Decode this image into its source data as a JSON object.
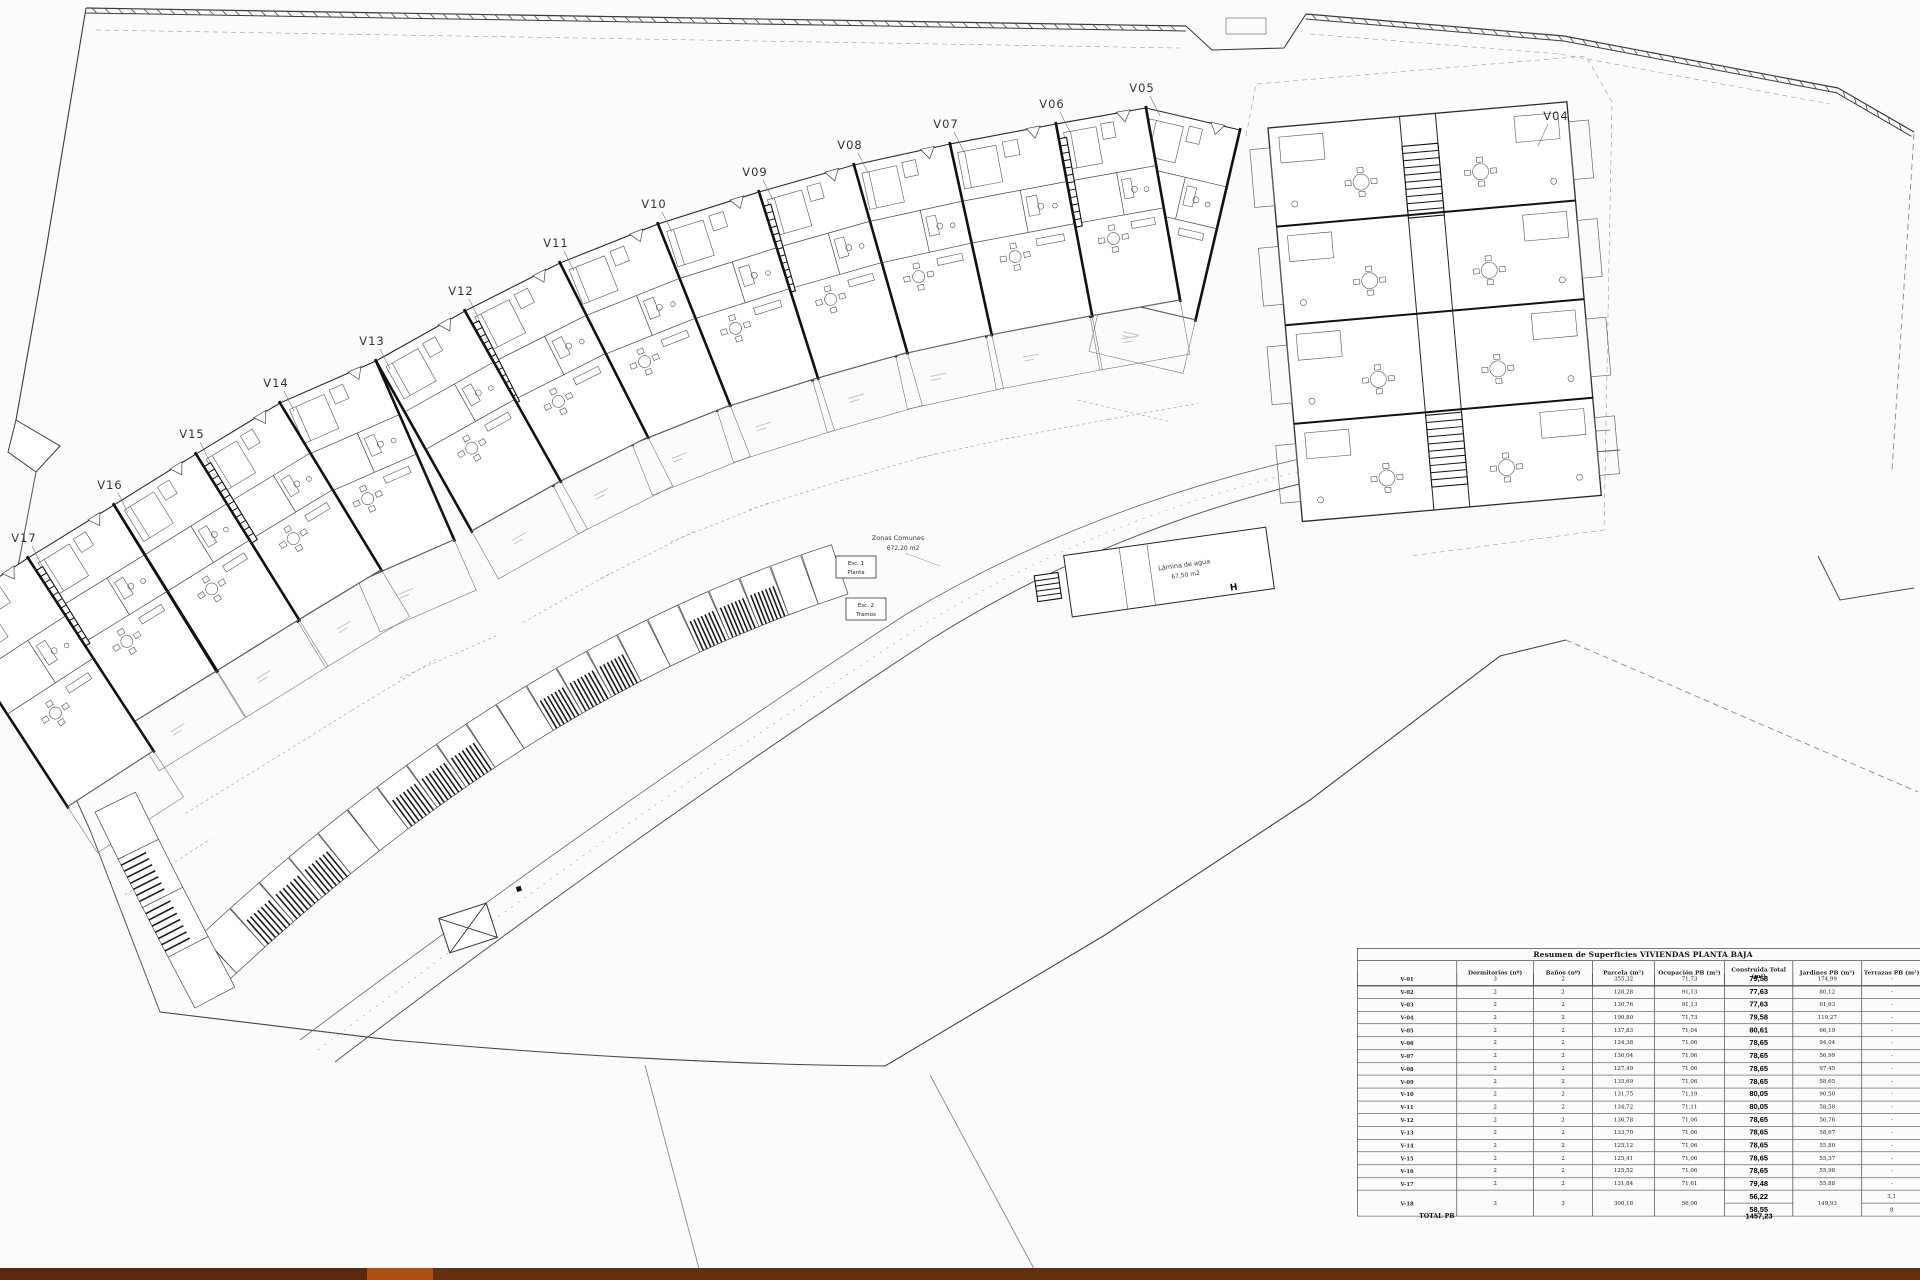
{
  "plan": {
    "paper_color": "#fcfbf9",
    "ink_color": "#2a2a2a",
    "villa_labels": [
      "V05",
      "V06",
      "V07",
      "V08",
      "V09",
      "V10",
      "V11",
      "V12",
      "V13",
      "V14",
      "V15",
      "V16",
      "V17",
      "V04"
    ],
    "annotations": {
      "zonas_comunes": [
        "Zonas Comunes",
        "672,20 m2"
      ],
      "lamina_de_agua": [
        "Lámina de agua",
        "67,50 m2"
      ],
      "esc1": [
        "Esc. 1",
        "Planta"
      ],
      "esc2": [
        "Esc. 2",
        "Tramos"
      ],
      "hydrant": "H"
    }
  },
  "table": {
    "title": "Resumen de Superficies VIVIENDAS PLANTA BAJA",
    "columns": [
      "",
      "Dormitorios (nº)",
      "Baños (nº)",
      "Parcela (m²)",
      "Ocupación PB (m²)",
      "Construida Total (m²)",
      "Jardines PB (m²)",
      "Terrazas PB (m²)"
    ],
    "rows": [
      {
        "id": "V-01",
        "dorm": "3",
        "banos": "2",
        "parcela": "355,32",
        "ocupacion": "71,73",
        "construida": "79,58",
        "jardines": "174,99",
        "terrazas": "-"
      },
      {
        "id": "V-02",
        "dorm": "2",
        "banos": "2",
        "parcela": "128,28",
        "ocupacion": "91,13",
        "construida": "77,63",
        "jardines": "80,12",
        "terrazas": "-"
      },
      {
        "id": "V-03",
        "dorm": "2",
        "banos": "2",
        "parcela": "130,76",
        "ocupacion": "91,13",
        "construida": "77,63",
        "jardines": "61,63",
        "terrazas": "-"
      },
      {
        "id": "V-04",
        "dorm": "2",
        "banos": "2",
        "parcela": "190,80",
        "ocupacion": "71,73",
        "construida": "79,58",
        "jardines": "119,27",
        "terrazas": "-"
      },
      {
        "id": "V-05",
        "dorm": "2",
        "banos": "2",
        "parcela": "137,83",
        "ocupacion": "71,04",
        "construida": "80,61",
        "jardines": "66,19",
        "terrazas": "-"
      },
      {
        "id": "V-06",
        "dorm": "2",
        "banos": "2",
        "parcela": "134,38",
        "ocupacion": "71,06",
        "construida": "78,65",
        "jardines": "94,04",
        "terrazas": "-"
      },
      {
        "id": "V-07",
        "dorm": "2",
        "banos": "2",
        "parcela": "136,04",
        "ocupacion": "71,06",
        "construida": "78,65",
        "jardines": "56,99",
        "terrazas": "-"
      },
      {
        "id": "V-08",
        "dorm": "2",
        "banos": "2",
        "parcela": "127,49",
        "ocupacion": "71,06",
        "construida": "78,65",
        "jardines": "97,45",
        "terrazas": "-"
      },
      {
        "id": "V-09",
        "dorm": "2",
        "banos": "2",
        "parcela": "135,69",
        "ocupacion": "71,06",
        "construida": "78,65",
        "jardines": "58,65",
        "terrazas": "-"
      },
      {
        "id": "V-10",
        "dorm": "2",
        "banos": "2",
        "parcela": "131,75",
        "ocupacion": "71,19",
        "construida": "80,05",
        "jardines": "90,50",
        "terrazas": "-"
      },
      {
        "id": "V-11",
        "dorm": "2",
        "banos": "2",
        "parcela": "134,72",
        "ocupacion": "71,11",
        "construida": "80,05",
        "jardines": "58,58",
        "terrazas": "-"
      },
      {
        "id": "V-12",
        "dorm": "2",
        "banos": "2",
        "parcela": "136,78",
        "ocupacion": "71,06",
        "construida": "78,65",
        "jardines": "56,76",
        "terrazas": "-"
      },
      {
        "id": "V-13",
        "dorm": "2",
        "banos": "2",
        "parcela": "133,70",
        "ocupacion": "71,06",
        "construida": "78,65",
        "jardines": "58,67",
        "terrazas": "-"
      },
      {
        "id": "V-14",
        "dorm": "2",
        "banos": "2",
        "parcela": "125,12",
        "ocupacion": "71,06",
        "construida": "78,65",
        "jardines": "55,80",
        "terrazas": "-"
      },
      {
        "id": "V-15",
        "dorm": "2",
        "banos": "2",
        "parcela": "125,41",
        "ocupacion": "71,06",
        "construida": "78,65",
        "jardines": "55,37",
        "terrazas": "-"
      },
      {
        "id": "V-16",
        "dorm": "2",
        "banos": "2",
        "parcela": "125,52",
        "ocupacion": "71,06",
        "construida": "78,65",
        "jardines": "55,98",
        "terrazas": "-"
      },
      {
        "id": "V-17",
        "dorm": "2",
        "banos": "2",
        "parcela": "131,84",
        "ocupacion": "71,61",
        "construida": "79,48",
        "jardines": "55,88",
        "terrazas": "-"
      },
      {
        "id": "V-18",
        "dorm": "3",
        "banos": "3",
        "parcela": "300,18",
        "ocupacion": "56,00",
        "construida": [
          "56,22",
          "58,55"
        ],
        "jardines": "149,93",
        "terrazas": [
          "3,1",
          "8"
        ]
      }
    ],
    "total_label": "TOTAL PB",
    "total_value": "1457,23"
  },
  "footer": {
    "segments": [
      {
        "x": 0,
        "w": 367,
        "color": "#5b2a0e"
      },
      {
        "x": 367,
        "w": 66,
        "color": "#b14e10"
      },
      {
        "x": 433,
        "w": 1487,
        "color": "#64300f"
      }
    ]
  }
}
